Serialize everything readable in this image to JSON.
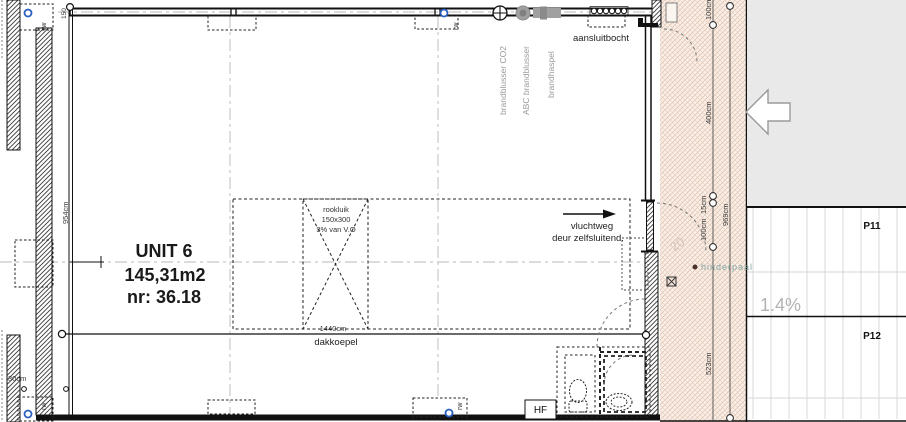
{
  "unit": {
    "name": "UNIT 6",
    "area": "145,31m2",
    "number": "nr: 36.18"
  },
  "skylight": {
    "rookluik_line1": "rookluik",
    "rookluik_line2": "150x300",
    "rookluik_line3": "3% van V.O",
    "width": "1440cm",
    "label": "dakkoepel"
  },
  "escape_route": {
    "line1": "vluchtweg",
    "line2": "deur zelfsluitend."
  },
  "fire_equipment": {
    "co2_extinguisher": "brandblusser CO2",
    "abc_extinguisher": "ABC brandblusser",
    "hose_reel": "brandhaspel",
    "connection_bend": "aansluitbocht"
  },
  "site": {
    "bollard_label": "hinderpaal",
    "slope": "1.4%",
    "parking_p11": "P11",
    "parking_p12": "P12",
    "hf_label": "HF",
    "faint_mark": "20"
  },
  "drains": {
    "label": "rw"
  },
  "dimensions": {
    "left_height": "954cm",
    "wall_width": "30cm",
    "corner": "150",
    "road_top": "100cm",
    "road_upper": "400cm",
    "road_step": "15cm",
    "road_mid": "100cm",
    "road_lower": "523cm",
    "road_total": "969cm"
  },
  "colors": {
    "wall_line": "#1a1a1a",
    "road_hatch": "#dcb49f",
    "road_background": "#f8efe8",
    "gray_area": "#e9e9e9",
    "centerline_gray": "#b8b8b8",
    "equipment_gray": "#9a9a9a",
    "drain_blue": "#2b5fc0",
    "bollard_text": "#84a7a2"
  }
}
